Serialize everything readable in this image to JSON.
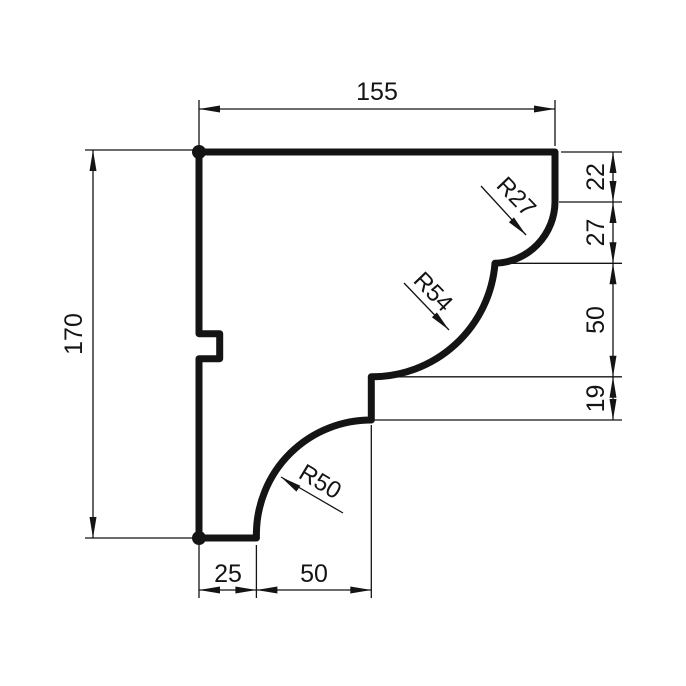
{
  "drawing": {
    "kind": "dimensioned profile cross-section (cornice moulding)",
    "dims": {
      "top_width": "155",
      "left_height": "170",
      "right_seg_1": "22",
      "right_seg_2": "27",
      "right_seg_3": "50",
      "right_seg_4": "19",
      "bottom_seg_1": "25",
      "bottom_seg_2": "50"
    },
    "radii": {
      "r27": "R27",
      "r54": "R54",
      "r50": "R50"
    },
    "colors": {
      "line": "#141414",
      "background": "#ffffff"
    }
  }
}
